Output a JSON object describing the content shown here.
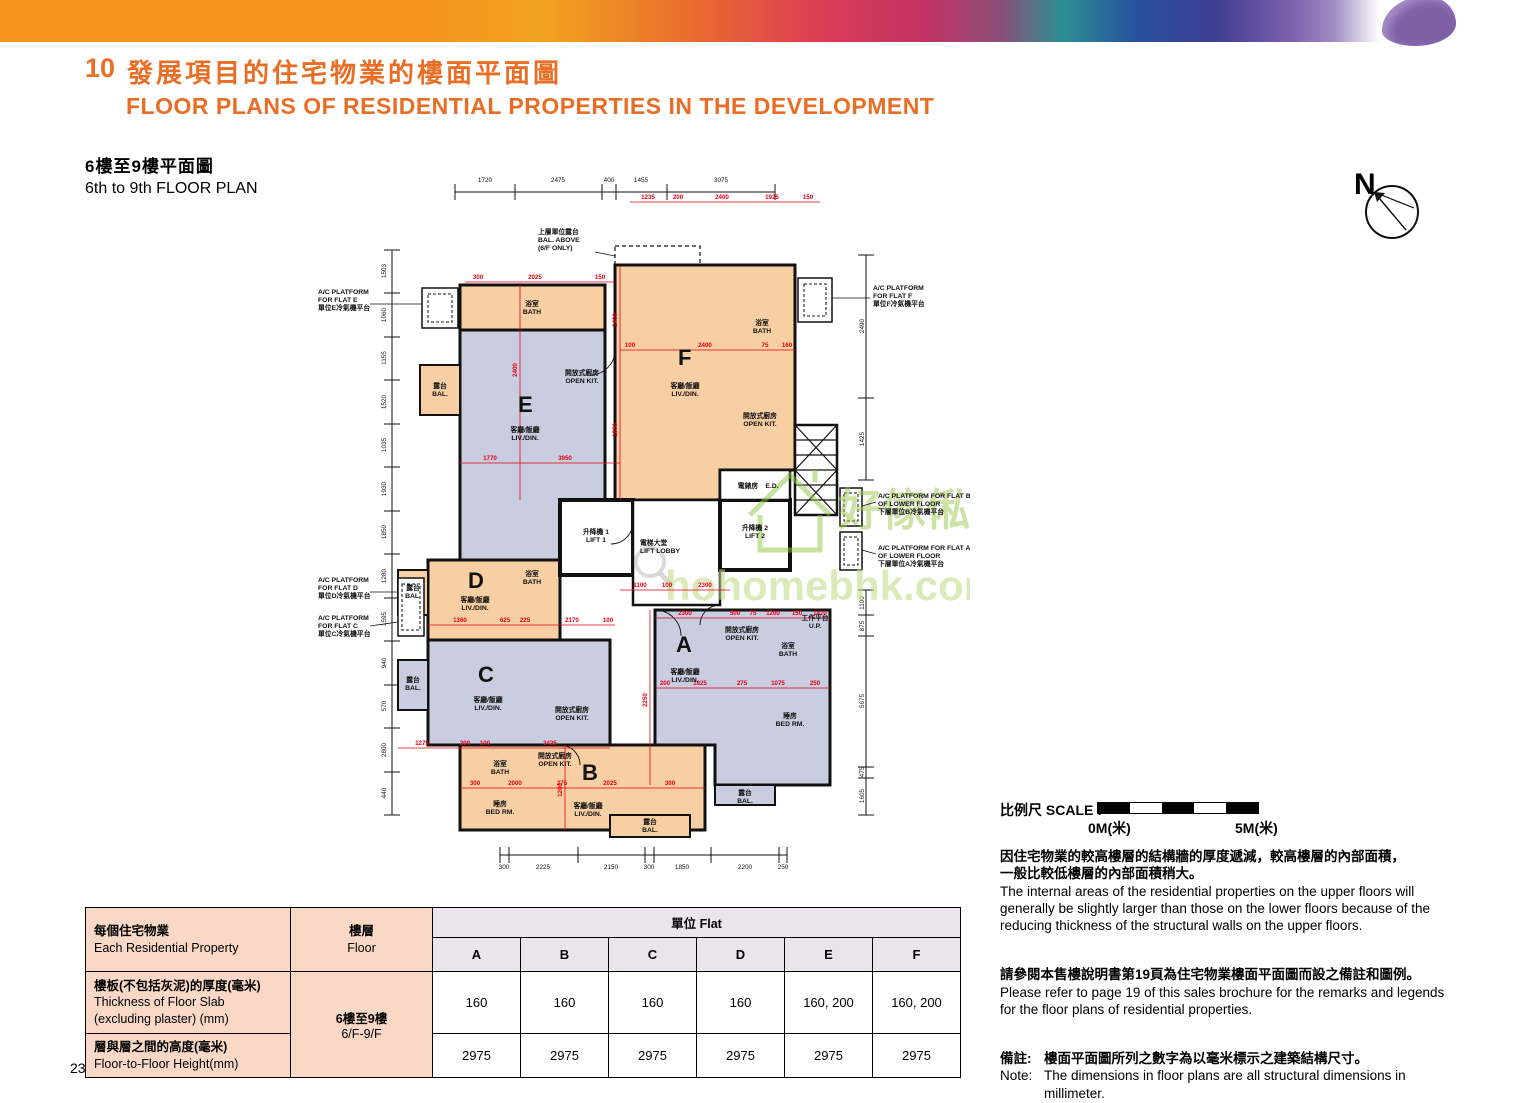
{
  "header": {
    "section_number": "10",
    "title_zh": "發展項目的住宅物業的樓面平面圖",
    "title_en": "FLOOR PLANS OF RESIDENTIAL PROPERTIES IN THE DEVELOPMENT",
    "accent_color": "#E96D24"
  },
  "subtitle": {
    "zh": "6樓至9樓平面圖",
    "en": "6th to 9th FLOOR PLAN"
  },
  "compass": {
    "label": "N"
  },
  "page": {
    "number": "23"
  },
  "scale": {
    "label": "比例尺 SCALE :",
    "start": "0M(米)",
    "end": "5M(米)"
  },
  "notes": {
    "para1_zh_1": "因住宅物業的較高樓層的結構牆的厚度遞減，較高樓層的內部面積，",
    "para1_zh_2": "一般比較低樓層的內部面積稍大。",
    "para1_en": "The internal areas of the residential properties on the upper floors will generally be slightly larger than those on the lower floors because of the reducing thickness of the structural walls on the upper floors.",
    "para2_zh": "請參閱本售樓說明書第19頁為住宅物業樓面平面圖而設之備註和圖例。",
    "para2_en": "Please refer to page 19 of this sales brochure for the remarks and legends for the floor plans of residential properties.",
    "note_label_zh": "備註:",
    "note_zh": "樓面平面圖所列之數字為以毫米標示之建築結構尺寸。",
    "note_label_en": "Note:",
    "note_en": "The dimensions in floor plans are all structural dimensions in millimeter."
  },
  "table": {
    "col1_zh": "每個住宅物業",
    "col1_en": "Each Residential Property",
    "col2_zh": "樓層",
    "col2_en": "Floor",
    "flat_header": "單位 Flat",
    "flat_columns": [
      "A",
      "B",
      "C",
      "D",
      "E",
      "F"
    ],
    "floor_zh": "6樓至9樓",
    "floor_en": "6/F-9/F",
    "rows": [
      {
        "label_zh": "樓板(不包括灰泥)的厚度(毫米)",
        "label_en1": "Thickness of Floor Slab",
        "label_en2": "(excluding plaster) (mm)",
        "values": [
          "160",
          "160",
          "160",
          "160",
          "160, 200",
          "160, 200"
        ]
      },
      {
        "label_zh": "層與層之間的高度(毫米)",
        "label_en1": "Floor-to-Floor Height(mm)",
        "label_en2": "",
        "values": [
          "2975",
          "2975",
          "2975",
          "2975",
          "2975",
          "2975"
        ]
      }
    ]
  },
  "plan": {
    "colors": {
      "flat_warm": "#F8CFA3",
      "flat_cool": "#C8CDE0",
      "dim_red": "#E60012"
    },
    "flat_letters": [
      "A",
      "B",
      "C",
      "D",
      "E",
      "F"
    ],
    "labels": {
      "liv_zh": "客廳/飯廳",
      "liv_en": "LIV./DIN.",
      "bath_zh": "浴室",
      "bath_en": "BATH",
      "kit_zh": "開放式廚房",
      "kit_en": "OPEN KIT.",
      "bed_zh": "睡房",
      "bed_en": "BED RM.",
      "bal_zh": "露台",
      "bal_en": "BAL.",
      "up_zh": "工作平台",
      "up_en": "U.P.",
      "lift1_zh": "升降機 1",
      "lift1_en": "LIFT 1",
      "lift2_zh": "升降機 2",
      "lift2_en": "LIFT 2",
      "lobby_zh": "電梯大堂",
      "lobby_en": "LIFT LOBBY",
      "ed_zh": "電錶房",
      "ed_en": "E.D."
    },
    "ac": {
      "e1": "A/C PLATFORM",
      "e2": "FOR FLAT E",
      "e3": "單位E冷氣機平台",
      "d1": "A/C PLATFORM",
      "d2": "FOR FLAT D",
      "d3": "單位D冷氣機平台",
      "c1": "A/C PLATFORM",
      "c2": "FOR FLAT C",
      "c3": "單位C冷氣機平台",
      "f1": "A/C PLATFORM",
      "f2": "FOR FLAT F",
      "f3": "單位F冷氣機平台",
      "b1": "A/C PLATFORM FOR FLAT B",
      "b2": "OF LOWER FLOOR",
      "b3": "下層單位B冷氣機平台",
      "a1": "A/C PLATFORM FOR FLAT A",
      "a2": "OF LOWER FLOOR",
      "a3": "下層單位A冷氣機平台"
    },
    "above_note": {
      "zh": "上層單位露台",
      "en1": "BAL. ABOVE",
      "en2": "(6/F ONLY)"
    },
    "dims": {
      "top": [
        "1720",
        "2475",
        "400",
        "1455",
        "3075"
      ],
      "bottom": [
        "300",
        "2225",
        "2150",
        "300",
        "1850",
        "2200",
        "250"
      ],
      "left": [
        "1503",
        "1060",
        "1155",
        "1520",
        "1035",
        "1930",
        "1850",
        "1280",
        "1595",
        "940",
        "570",
        "2800",
        "440"
      ],
      "right_top": [
        "2490",
        "1425"
      ],
      "right_bottom": [
        "1100",
        "875",
        "5675",
        "475",
        "1605"
      ]
    },
    "red_dims": [
      "1235",
      "200",
      "2400",
      "1925",
      "150",
      "300",
      "2025",
      "150",
      "100",
      "2400",
      "75",
      "160",
      "1770",
      "3950",
      "1360",
      "625",
      "225",
      "2170",
      "100",
      "1275",
      "200",
      "100",
      "3425",
      "300",
      "2000",
      "275",
      "2025",
      "300",
      "200",
      "1825",
      "275",
      "1075",
      "250",
      "2300",
      "500",
      "75",
      "1200",
      "150",
      "1410",
      "2400",
      "1850",
      "2400",
      "2250",
      "1200",
      "1100",
      "100",
      "2300"
    ]
  },
  "watermark": {
    "zh": "好傢俬",
    "url": "hohomebhk.com"
  }
}
